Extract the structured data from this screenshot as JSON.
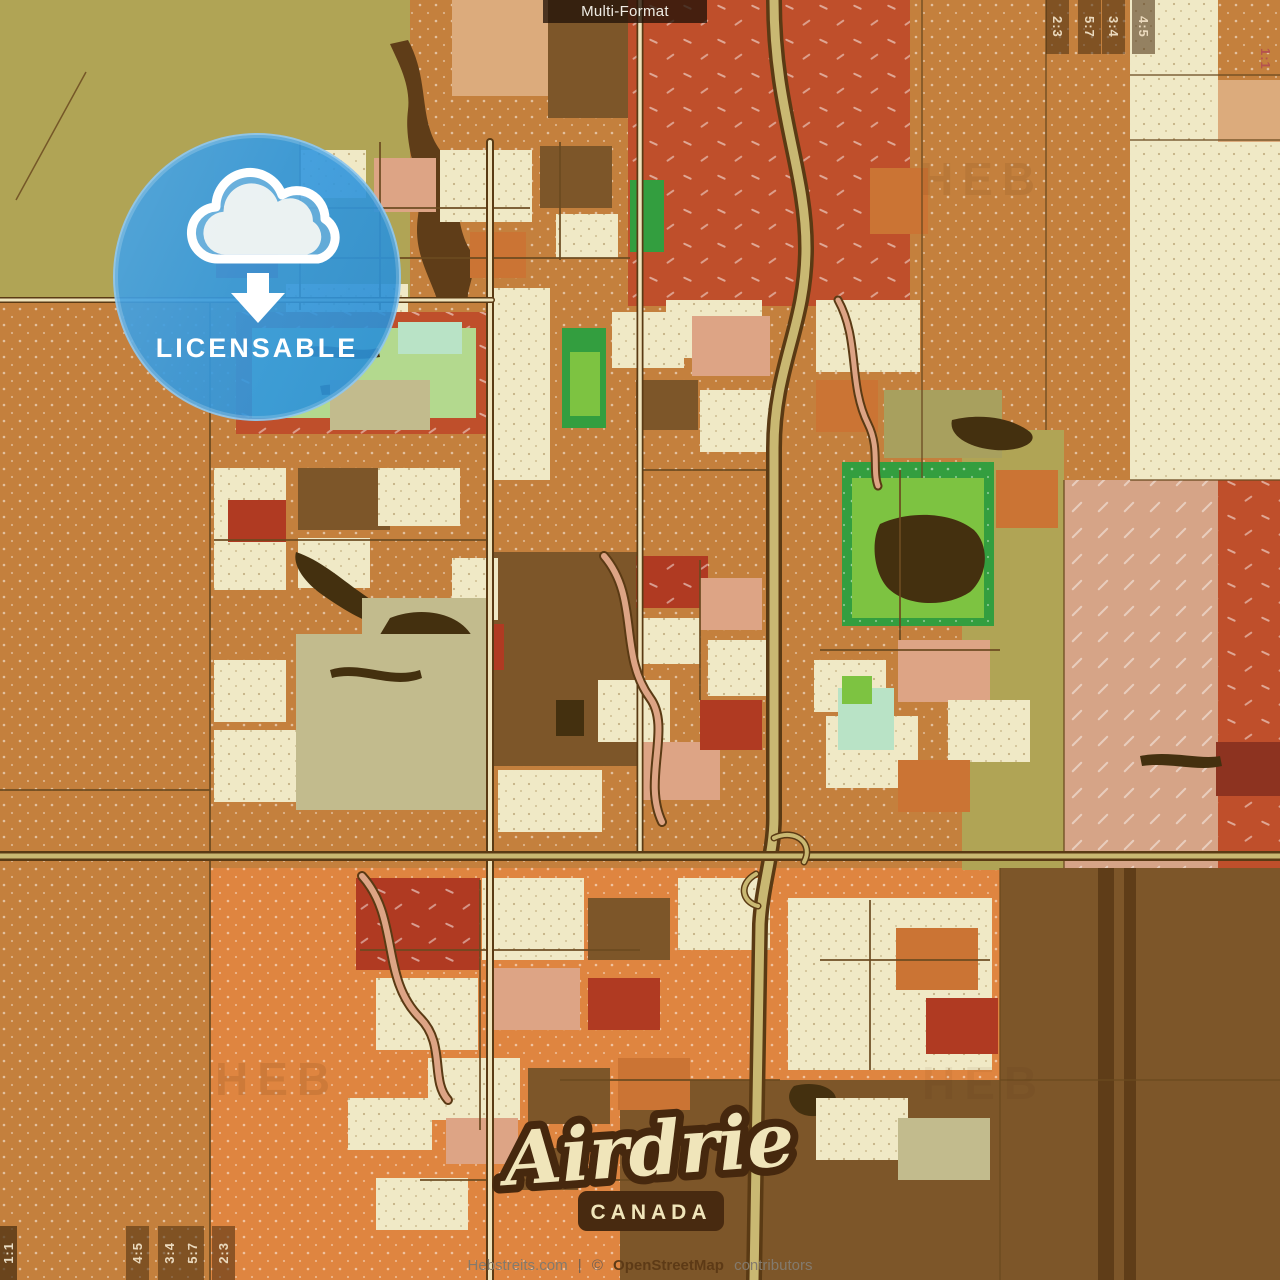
{
  "overlay": {
    "format_label": "Multi-Format",
    "badge": {
      "label": "LICENSABLE",
      "icon": "cloud-download-icon",
      "color": "#2e96e0"
    },
    "title": {
      "city": "Airdrie",
      "country": "CANADA"
    },
    "attribution": {
      "site": "Hebstreits.com",
      "separator": "|",
      "copyright": "©",
      "osm": "OpenStreetMap",
      "suffix": "contributors"
    },
    "watermark": "HEB",
    "ratios_top_right": [
      "2:3",
      "5:7",
      "3:4",
      "4:5"
    ],
    "ratio_square_top_right": "1:1",
    "ratios_bottom_left": [
      "4:5",
      "3:4",
      "5:7",
      "2:3"
    ],
    "ratio_square_bottom_left": "1:1"
  },
  "palette": {
    "ol": "#b0a455",
    "or": "#c4803d",
    "ob": "#df8540",
    "od": "#cb7434",
    "rf": "#bf4f2b",
    "rb": "#b03a22",
    "mr": "#8d3320",
    "cr": "#f0e9c6",
    "tn": "#dcab7c",
    "sa": "#dda485",
    "br": "#7d5629",
    "bd": "#5f3d18",
    "bx": "#44300f",
    "sg": "#c2bb8d",
    "ov": "#a8a05e",
    "gl": "#b3d98e",
    "gb": "#7dc341",
    "gd": "#339e3f",
    "mi": "#b9e3c6",
    "pk": "#d6a487",
    "ln": "#6b4a20",
    "rc": "#5a3a14",
    "rr": "#c9b872",
    "cw": "#efe3bb"
  },
  "map": {
    "shapes": [
      [
        "r",
        0,
        0,
        1280,
        1280,
        "or",
        "dots"
      ],
      [
        "r",
        210,
        868,
        790,
        412,
        "ob",
        "dots"
      ],
      [
        "r",
        0,
        0,
        410,
        298,
        "ol"
      ],
      [
        "p",
        "M408,40C430,80 418,120 440,150C462,180 452,220 470,250C480,268 466,288 468,300L438,302C428,272 413,252 418,216C423,180 403,150 408,110C411,85 398,62 390,44Z",
        "bd"
      ],
      [
        "r",
        452,
        0,
        96,
        96,
        "tn"
      ],
      [
        "r",
        548,
        0,
        84,
        118,
        "br"
      ],
      [
        "r",
        628,
        0,
        282,
        306,
        "rf",
        "dashes"
      ],
      [
        "r",
        1130,
        0,
        88,
        480,
        "cr",
        "dotsDark"
      ],
      [
        "r",
        1218,
        0,
        62,
        80,
        "or",
        "dots"
      ],
      [
        "r",
        1218,
        80,
        62,
        62,
        "tn"
      ],
      [
        "r",
        1218,
        142,
        62,
        338,
        "cr",
        "dotsDark"
      ],
      [
        "r",
        962,
        430,
        102,
        440,
        "ol"
      ],
      [
        "r",
        1064,
        480,
        154,
        390,
        "pk",
        "hatch"
      ],
      [
        "r",
        1218,
        480,
        62,
        390,
        "rf",
        "dashes"
      ],
      [
        "r",
        1000,
        868,
        280,
        412,
        "br"
      ],
      [
        "r",
        1098,
        868,
        16,
        412,
        "bd"
      ],
      [
        "r",
        1124,
        868,
        12,
        412,
        "bd"
      ],
      [
        "r",
        620,
        1080,
        382,
        200,
        "br"
      ],
      [
        "r",
        214,
        142,
        78,
        58,
        "ov"
      ],
      [
        "r",
        300,
        150,
        66,
        48,
        "cr",
        "dotsDark"
      ],
      [
        "r",
        374,
        158,
        62,
        54,
        "sa"
      ],
      [
        "r",
        216,
        232,
        62,
        46,
        "rb"
      ],
      [
        "r",
        286,
        284,
        122,
        50,
        "cr",
        "dotsDark"
      ],
      [
        "r",
        440,
        150,
        92,
        72,
        "cr",
        "dotsDark"
      ],
      [
        "r",
        470,
        232,
        56,
        46,
        "od"
      ],
      [
        "r",
        540,
        146,
        72,
        62,
        "br"
      ],
      [
        "r",
        556,
        214,
        62,
        44,
        "cr",
        "dotsDark"
      ],
      [
        "r",
        630,
        180,
        34,
        72,
        "gd"
      ],
      [
        "r",
        666,
        300,
        96,
        58,
        "cr",
        "dotsDark"
      ],
      [
        "r",
        870,
        168,
        58,
        66,
        "od"
      ],
      [
        "r",
        236,
        312,
        256,
        122,
        "rf",
        "dashes"
      ],
      [
        "r",
        252,
        328,
        224,
        90,
        "gl"
      ],
      [
        "p",
        "M300,348C335,342 355,354 378,348L380,357C352,362 328,355 302,357Z",
        "bx"
      ],
      [
        "p",
        "M320,386C350,380 380,392 408,386L410,395C382,400 350,393 322,395Z",
        "bx"
      ],
      [
        "r",
        330,
        380,
        100,
        50,
        "sg"
      ],
      [
        "r",
        398,
        322,
        64,
        32,
        "mi"
      ],
      [
        "r",
        492,
        288,
        58,
        192,
        "cr",
        "dotsDark"
      ],
      [
        "r",
        562,
        328,
        44,
        100,
        "gd"
      ],
      [
        "r",
        570,
        352,
        30,
        64,
        "gb"
      ],
      [
        "r",
        612,
        312,
        72,
        56,
        "cr",
        "dotsDark"
      ],
      [
        "r",
        692,
        316,
        78,
        60,
        "sa"
      ],
      [
        "r",
        636,
        380,
        62,
        50,
        "br"
      ],
      [
        "r",
        700,
        390,
        82,
        62,
        "cr",
        "dotsDark"
      ],
      [
        "r",
        816,
        300,
        104,
        72,
        "cr",
        "dotsDark"
      ],
      [
        "r",
        816,
        380,
        62,
        52,
        "od"
      ],
      [
        "r",
        884,
        390,
        118,
        68,
        "ov"
      ],
      [
        "p",
        "M952,420C985,412 1015,420 1030,432C1040,442 1020,452 995,450C970,448 948,436 952,420Z",
        "bx"
      ],
      [
        "r",
        214,
        468,
        72,
        122,
        "cr",
        "dotsDark"
      ],
      [
        "r",
        228,
        500,
        58,
        42,
        "rb"
      ],
      [
        "r",
        298,
        468,
        92,
        62,
        "br"
      ],
      [
        "r",
        298,
        538,
        72,
        50,
        "cr",
        "dotsDark"
      ],
      [
        "r",
        378,
        468,
        82,
        58,
        "cr",
        "dotsDark"
      ],
      [
        "p",
        "M296,552C320,560 340,578 360,592C380,606 396,618 392,628C370,626 344,610 324,596C306,584 292,566 296,552Z",
        "bx"
      ],
      [
        "r",
        494,
        552,
        148,
        214,
        "br"
      ],
      [
        "r",
        452,
        558,
        46,
        62,
        "cr",
        "dotsDark"
      ],
      [
        "r",
        462,
        624,
        42,
        46,
        "rb"
      ],
      [
        "r",
        362,
        598,
        130,
        144,
        "sg"
      ],
      [
        "p",
        "M390,618C420,606 458,612 472,636C484,658 476,690 458,708C436,724 404,722 390,702C376,684 372,656 378,638Z",
        "bx"
      ],
      [
        "r",
        636,
        556,
        72,
        52,
        "rb",
        "dashes"
      ],
      [
        "r",
        642,
        618,
        58,
        46,
        "cr",
        "dotsDark"
      ],
      [
        "r",
        700,
        578,
        62,
        52,
        "sa"
      ],
      [
        "r",
        708,
        640,
        72,
        56,
        "cr",
        "dotsDark"
      ],
      [
        "r",
        842,
        462,
        152,
        164,
        "gd",
        "dots"
      ],
      [
        "r",
        852,
        478,
        132,
        140,
        "gb"
      ],
      [
        "p",
        "M880,524C910,510 952,512 974,530C990,546 988,576 970,592C946,608 908,606 890,590C874,576 870,542 880,524Z",
        "bx"
      ],
      [
        "r",
        996,
        470,
        62,
        58,
        "od"
      ],
      [
        "r",
        296,
        634,
        196,
        176,
        "sg"
      ],
      [
        "p",
        "M330,670C360,660 390,680 420,670L422,678C392,690 362,670 332,678Z",
        "bx"
      ],
      [
        "r",
        214,
        660,
        72,
        62,
        "cr",
        "dotsDark"
      ],
      [
        "r",
        214,
        730,
        82,
        72,
        "cr",
        "dotsDark"
      ],
      [
        "r",
        498,
        770,
        104,
        62,
        "cr",
        "dotsDark"
      ],
      [
        "r",
        556,
        700,
        28,
        36,
        "bx"
      ],
      [
        "r",
        598,
        680,
        72,
        62,
        "cr",
        "dotsDark"
      ],
      [
        "r",
        638,
        742,
        82,
        58,
        "sa"
      ],
      [
        "r",
        700,
        700,
        62,
        50,
        "rb"
      ],
      [
        "r",
        814,
        660,
        72,
        52,
        "cr",
        "dotsDark"
      ],
      [
        "r",
        826,
        716,
        92,
        72,
        "cr",
        "dotsDark"
      ],
      [
        "r",
        838,
        688,
        56,
        62,
        "mi"
      ],
      [
        "r",
        898,
        640,
        92,
        62,
        "sa"
      ],
      [
        "r",
        948,
        700,
        82,
        62,
        "cr",
        "dotsDark"
      ],
      [
        "r",
        898,
        760,
        72,
        52,
        "od"
      ],
      [
        "r",
        842,
        676,
        30,
        28,
        "gb"
      ],
      [
        "r",
        356,
        878,
        124,
        92,
        "rb",
        "dashes"
      ],
      [
        "r",
        482,
        878,
        102,
        82,
        "cr",
        "dotsDark"
      ],
      [
        "r",
        588,
        898,
        82,
        62,
        "br"
      ],
      [
        "r",
        678,
        878,
        92,
        72,
        "cr",
        "dotsDark"
      ],
      [
        "r",
        376,
        978,
        102,
        72,
        "cr",
        "dotsDark"
      ],
      [
        "r",
        488,
        968,
        92,
        62,
        "sa"
      ],
      [
        "r",
        588,
        978,
        72,
        52,
        "rb"
      ],
      [
        "r",
        428,
        1058,
        92,
        62,
        "cr",
        "dotsDark"
      ],
      [
        "r",
        528,
        1068,
        82,
        56,
        "br"
      ],
      [
        "r",
        618,
        1058,
        72,
        52,
        "od"
      ],
      [
        "r",
        788,
        898,
        204,
        172,
        "cr",
        "dotsDark"
      ],
      [
        "r",
        896,
        928,
        82,
        62,
        "od"
      ],
      [
        "r",
        926,
        998,
        72,
        56,
        "rb"
      ],
      [
        "p",
        "M794,1086C816,1080 838,1088 836,1102C832,1116 810,1120 798,1112C788,1104 786,1094 794,1086Z",
        "bx"
      ],
      [
        "r",
        348,
        1098,
        84,
        52,
        "cr",
        "dotsDark"
      ],
      [
        "r",
        446,
        1118,
        72,
        46,
        "sa"
      ],
      [
        "r",
        376,
        1178,
        92,
        52,
        "cr",
        "dotsDark"
      ],
      [
        "r",
        516,
        1148,
        62,
        42,
        "br"
      ],
      [
        "r",
        816,
        1098,
        92,
        62,
        "cr",
        "dotsDark"
      ],
      [
        "r",
        898,
        1118,
        92,
        62,
        "sg"
      ],
      [
        "r",
        1216,
        742,
        64,
        54,
        "mr"
      ],
      [
        "p",
        "M1140,756C1170,750 1200,760 1220,756L1222,766C1198,772 1168,762 1142,766Z",
        "bx"
      ]
    ],
    "lines": [
      [
        "M86,72L16,200",
        1.5
      ],
      [
        "M0,298L410,298",
        2
      ],
      [
        "M922,0L922,478",
        1.5
      ],
      [
        "M1046,0L1046,430",
        1.5
      ],
      [
        "M1130,75L1280,75",
        1.5
      ],
      [
        "M1130,140L1280,140",
        1.5
      ],
      [
        "M1130,480L1280,480",
        1.5
      ],
      [
        "M1064,480L1064,868",
        1.5
      ],
      [
        "M210,300L210,1280",
        2
      ],
      [
        "M0,790L210,790",
        2
      ],
      [
        "M1000,868L1000,1280",
        1.5
      ],
      [
        "M1000,1080L1280,1080",
        1.5
      ],
      [
        "M214,208L530,208",
        2
      ],
      [
        "M214,258L630,258",
        2
      ],
      [
        "M300,142L300,310",
        2
      ],
      [
        "M380,142L380,310",
        2
      ],
      [
        "M560,142L560,260",
        2
      ],
      [
        "M214,540L490,540",
        2
      ],
      [
        "M640,470L770,470",
        2
      ],
      [
        "M700,560L700,700",
        2
      ],
      [
        "M820,650L1000,650",
        2
      ],
      [
        "M900,470L900,640",
        2
      ],
      [
        "M480,880L480,1130",
        2
      ],
      [
        "M360,950L640,950",
        2
      ],
      [
        "M560,1080L780,1080",
        2
      ],
      [
        "M820,960L990,960",
        2
      ],
      [
        "M870,900L870,1070",
        2
      ],
      [
        "M420,1180L640,1180",
        2
      ]
    ],
    "roads": [
      [
        "M774,0C774,110 806,170 806,248C806,326 774,366 774,448L774,818C774,852 762,886 760,924L754,1280",
        16,
        9,
        "rr"
      ],
      [
        "M490,142L490,1280",
        8,
        4,
        "cw"
      ],
      [
        "M640,0L640,858",
        7,
        3.5,
        "cw"
      ],
      [
        "M0,856L1280,856",
        10,
        5,
        "rr"
      ],
      [
        "M0,300L492,300",
        6,
        3,
        "cw"
      ],
      [
        "M604,556C640,598 618,654 650,698C672,728 642,780 662,822",
        10,
        6,
        "sa"
      ],
      [
        "M362,876C400,918 380,978 420,1018C446,1044 430,1080 448,1100",
        10,
        6,
        "sa"
      ],
      [
        "M838,300C860,340 848,384 868,424C880,448 872,470 878,486",
        9,
        5,
        "sa"
      ],
      [
        "M774,838C796,828 814,844 804,862",
        7,
        4,
        "rr"
      ],
      [
        "M756,874C738,884 742,902 758,906",
        7,
        4,
        "rr"
      ]
    ]
  }
}
